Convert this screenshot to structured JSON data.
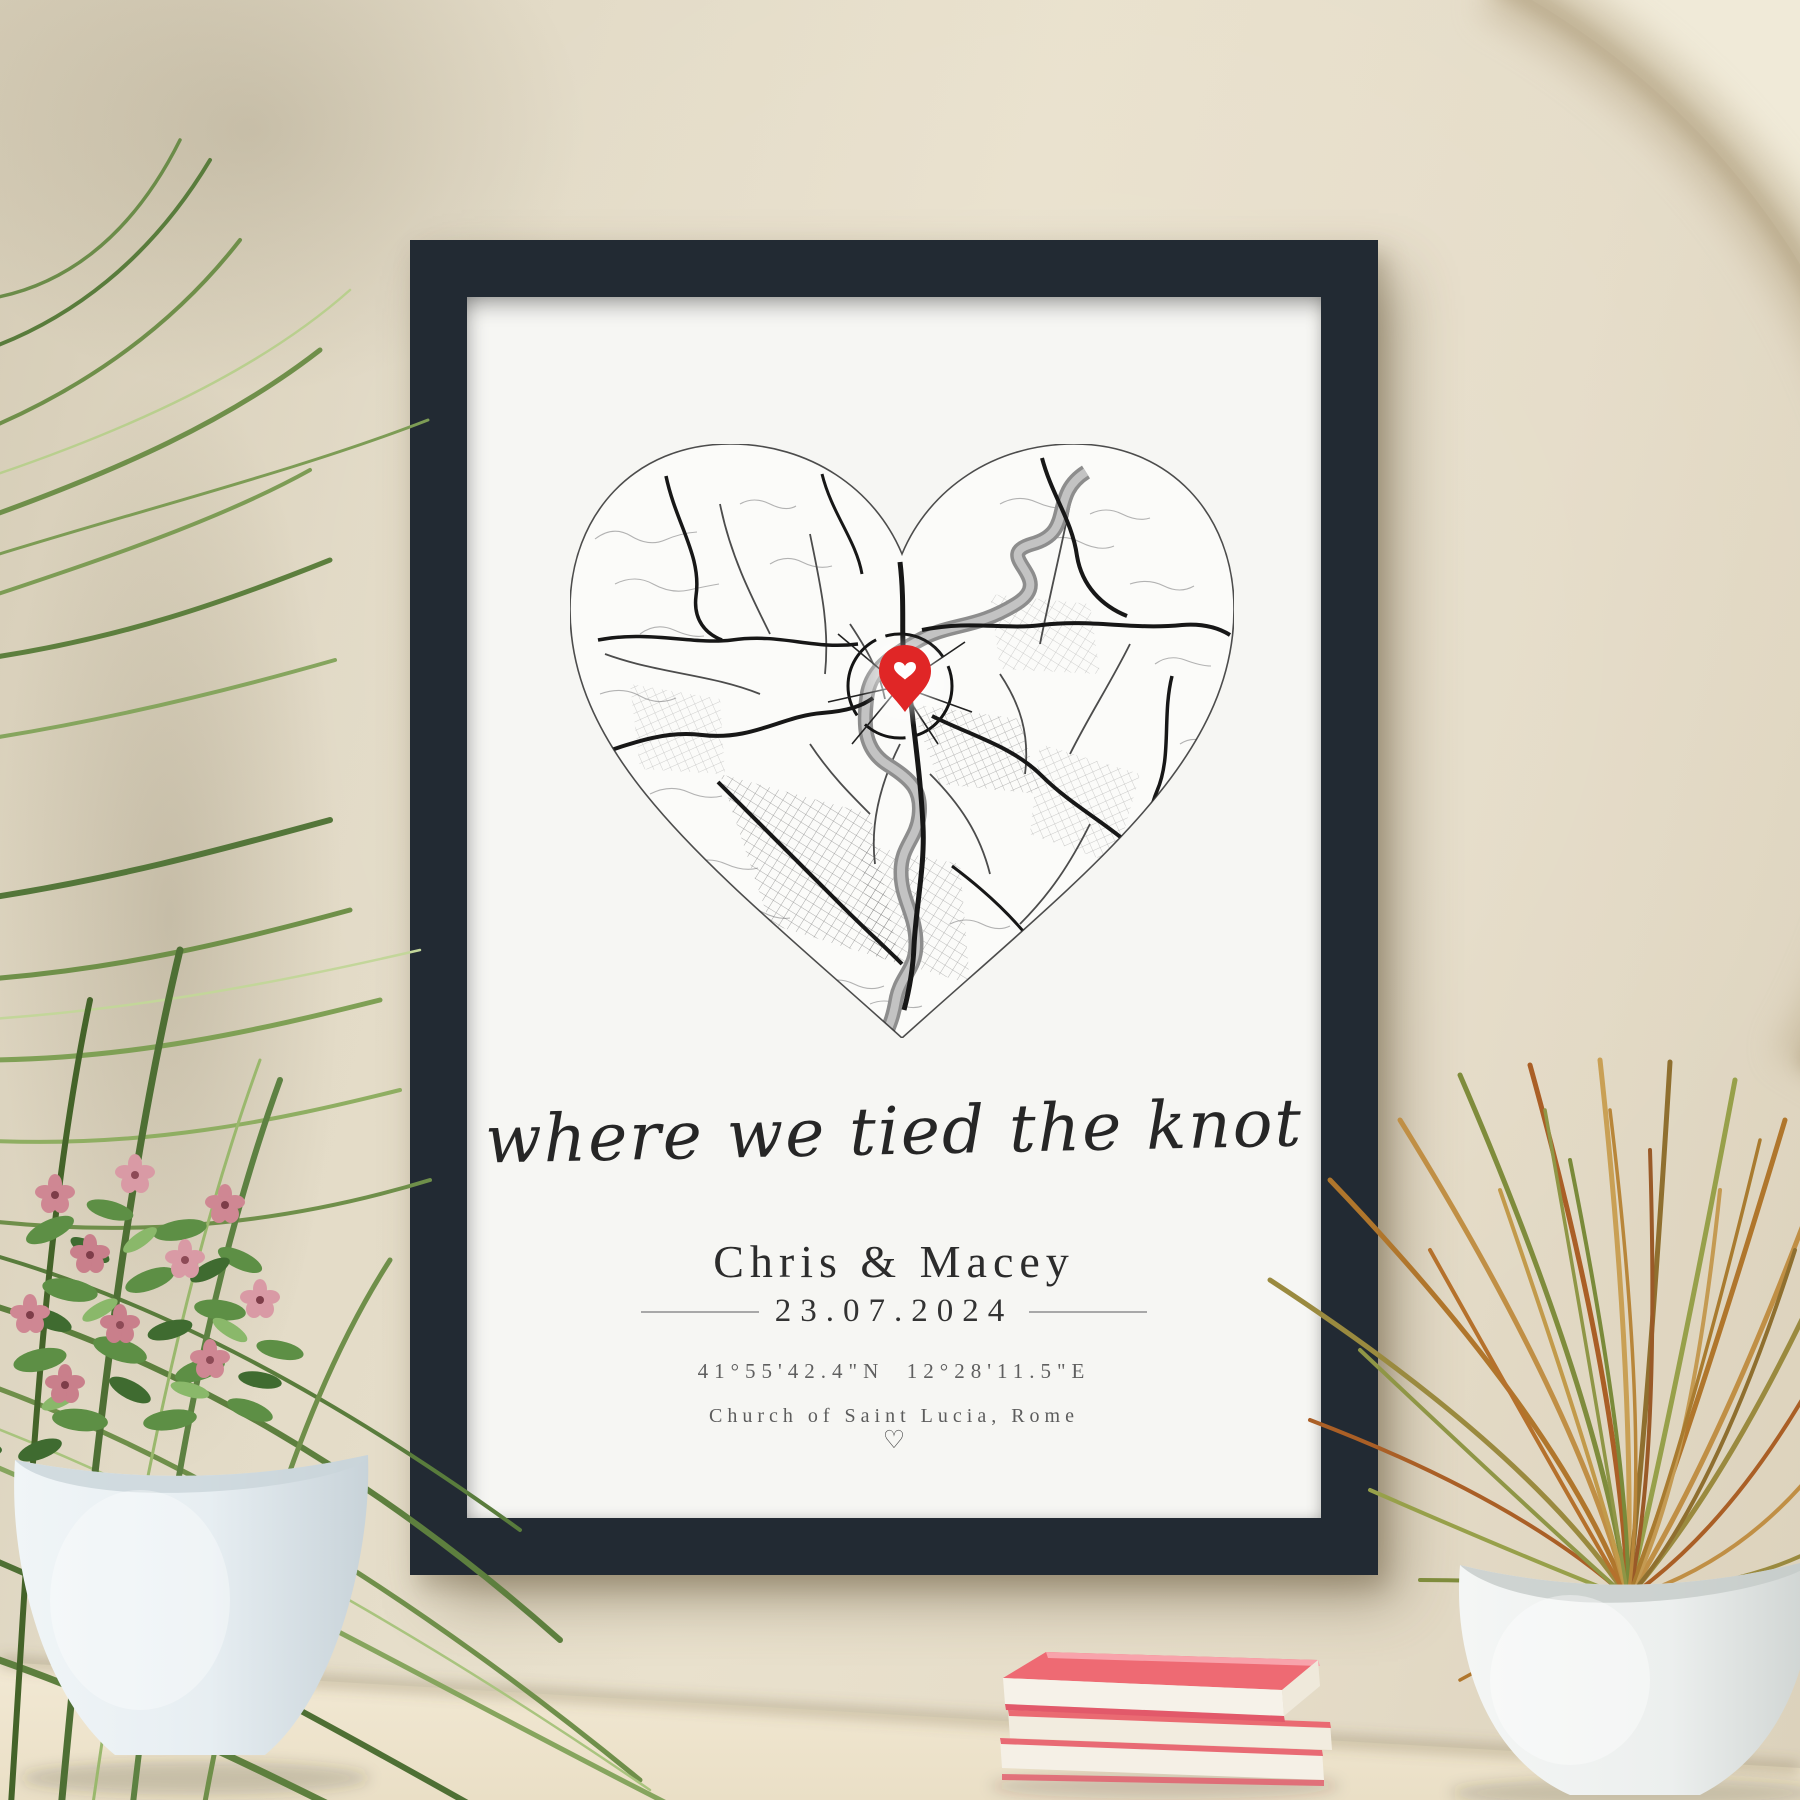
{
  "scene": {
    "wall_color": "#e5ddc9",
    "table_color": "#efe6d1",
    "arch_band_color": "#bfb092"
  },
  "frame": {
    "color": "#222a33",
    "mat_color": "#f6f6f3"
  },
  "poster": {
    "script_line": "where we tied the knot",
    "names": "Chris & Macey",
    "date": "23.07.2024",
    "coordinates": "41°55'42.4\"N  12°28'11.5\"E",
    "location": "Church of Saint Lucia, Rome",
    "footer_glyph": "♡",
    "map": {
      "shape": "heart",
      "city_style": "black-and-white street map",
      "river_color": "#8d8d8d",
      "road_color": "#171717",
      "pin_color": "#e02626",
      "pin_icon": "heart"
    }
  },
  "decor": {
    "books_count": 3,
    "book_cover_color": "#ee6a73",
    "left_pot_color": "#e7eef2",
    "right_pot_color": "#eef0ee",
    "flower_color": "#cf8793",
    "leaf_color": "#5d8142",
    "dry_grass_color": "#b0762c"
  }
}
